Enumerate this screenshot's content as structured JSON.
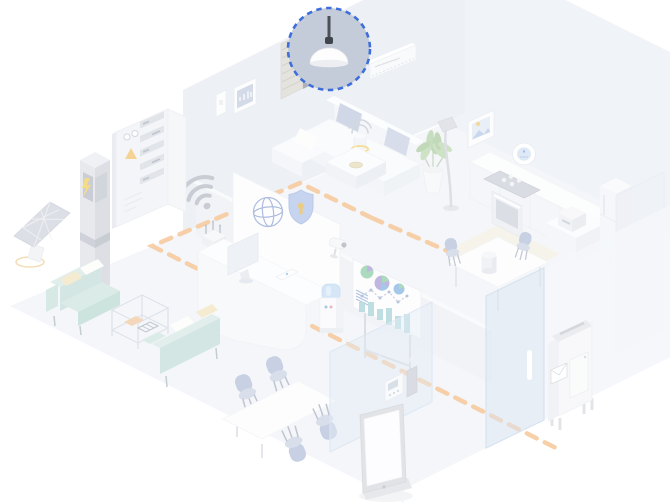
{
  "scene": {
    "type": "isometric-smart-building-illustration",
    "highlighted_device": "pendant-lamp",
    "rooms": [
      "living-room",
      "kitchen-dining",
      "office-lounge",
      "outdoor"
    ],
    "objects": [
      "pendant-lamp",
      "window-blind",
      "light-switch",
      "wall-control-panel",
      "ac-unit",
      "picture-frame",
      "thermostat-dial",
      "electrical-panel",
      "battery-tower",
      "solar-panel",
      "wifi-signal",
      "router",
      "reception-desk",
      "monitor",
      "tablet",
      "security-camera",
      "wall-screen",
      "globe-icon",
      "security-shield",
      "water-cooler",
      "presentation-board",
      "sectional-sofa",
      "smart-speaker",
      "side-table",
      "coffee-table",
      "potted-plant",
      "floor-lamp",
      "kitchen-counter",
      "cooktop",
      "oven",
      "kitchen-appliance",
      "fridge-cabinet",
      "dining-table",
      "dining-chair",
      "lounge-sofa",
      "glass-table",
      "conference-table",
      "conference-chair",
      "kiosk-display",
      "glass-partition",
      "glass-door",
      "intercom-panel",
      "mailbox",
      "dashed-route"
    ]
  },
  "colors": {
    "highlight_stroke": "#3e6edb",
    "highlight_fill": "#c5ccd9",
    "route_orange": "#f2ab66",
    "sofa_teal": "#b9d8d2",
    "accent_yellow": "#eec73d",
    "chair_blue": "#a7b5d4",
    "shield_blue": "#a6bbe6",
    "glass_blue": "#c3d8ee",
    "wall": "#e4e9f0",
    "floor": "#eef1f6",
    "icon_gray": "#a9aeb9",
    "lamp_rod": "#4a4f58"
  }
}
